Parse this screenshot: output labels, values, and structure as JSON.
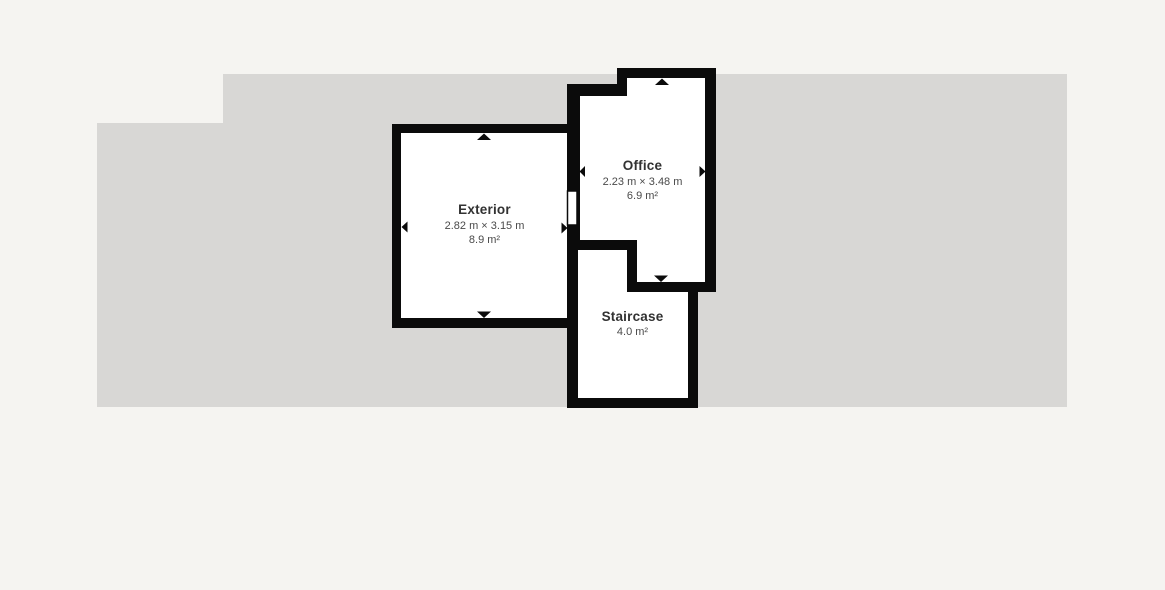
{
  "floorplan": {
    "colors": {
      "page_background": "#f5f4f1",
      "footprint": "#d8d7d5",
      "wall": "#0b0b0b",
      "room_fill": "#ffffff",
      "label_title": "#323232",
      "label_detail": "#4a4a4a"
    },
    "rooms": [
      {
        "name": "Exterior",
        "dimensions": "2.82 m × 3.15 m",
        "area": "8.9 m²"
      },
      {
        "name": "Office",
        "dimensions": "2.23 m × 3.48 m",
        "area": "6.9 m²"
      },
      {
        "name": "Staircase",
        "area": "4.0 m²"
      }
    ]
  }
}
